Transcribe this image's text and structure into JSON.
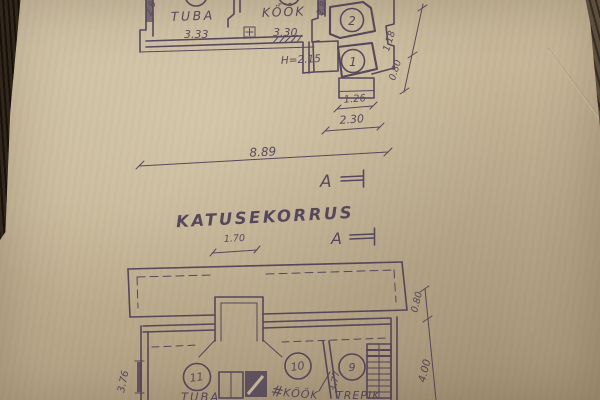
{
  "colors": {
    "ink": "#4a3c55",
    "paper": "#c7b798",
    "surface_dark": "#342b21"
  },
  "upper_plan": {
    "room_tuba_label": "TUBA",
    "room_tuba_size": "3.33",
    "room_kook_label": "KÖÖK",
    "room_kook_size": "3.30",
    "height_note": "H=2.15",
    "room_circle_2": "2",
    "room_circle_1": "1",
    "dim_left_vertical": "2.8",
    "dim_right_vertical": "2.8",
    "dim_diag_upper": "1.18",
    "dim_diag_lower": "0.80",
    "dim_porch_width": "1.26",
    "dim_entry_width": "2.30",
    "dim_total_width": "8.89",
    "section_marker": "A"
  },
  "title": "KATUSEKORRUS",
  "between": {
    "dim_width": "1.70",
    "section_marker": "A"
  },
  "lower_plan": {
    "room_circle_11": "11",
    "room_tuba_label": "TUBA",
    "room_circle_10": "10",
    "room_kook_label": "KÖÖK",
    "room_circle_9": "9",
    "room_trepik_label": "TREPIK.",
    "grate_symbol": "#",
    "dim_left_vertical": "3.76",
    "dim_mid_vertical": "3.77",
    "dim_right_upper": "0.80",
    "dim_right_total": "4.00"
  }
}
